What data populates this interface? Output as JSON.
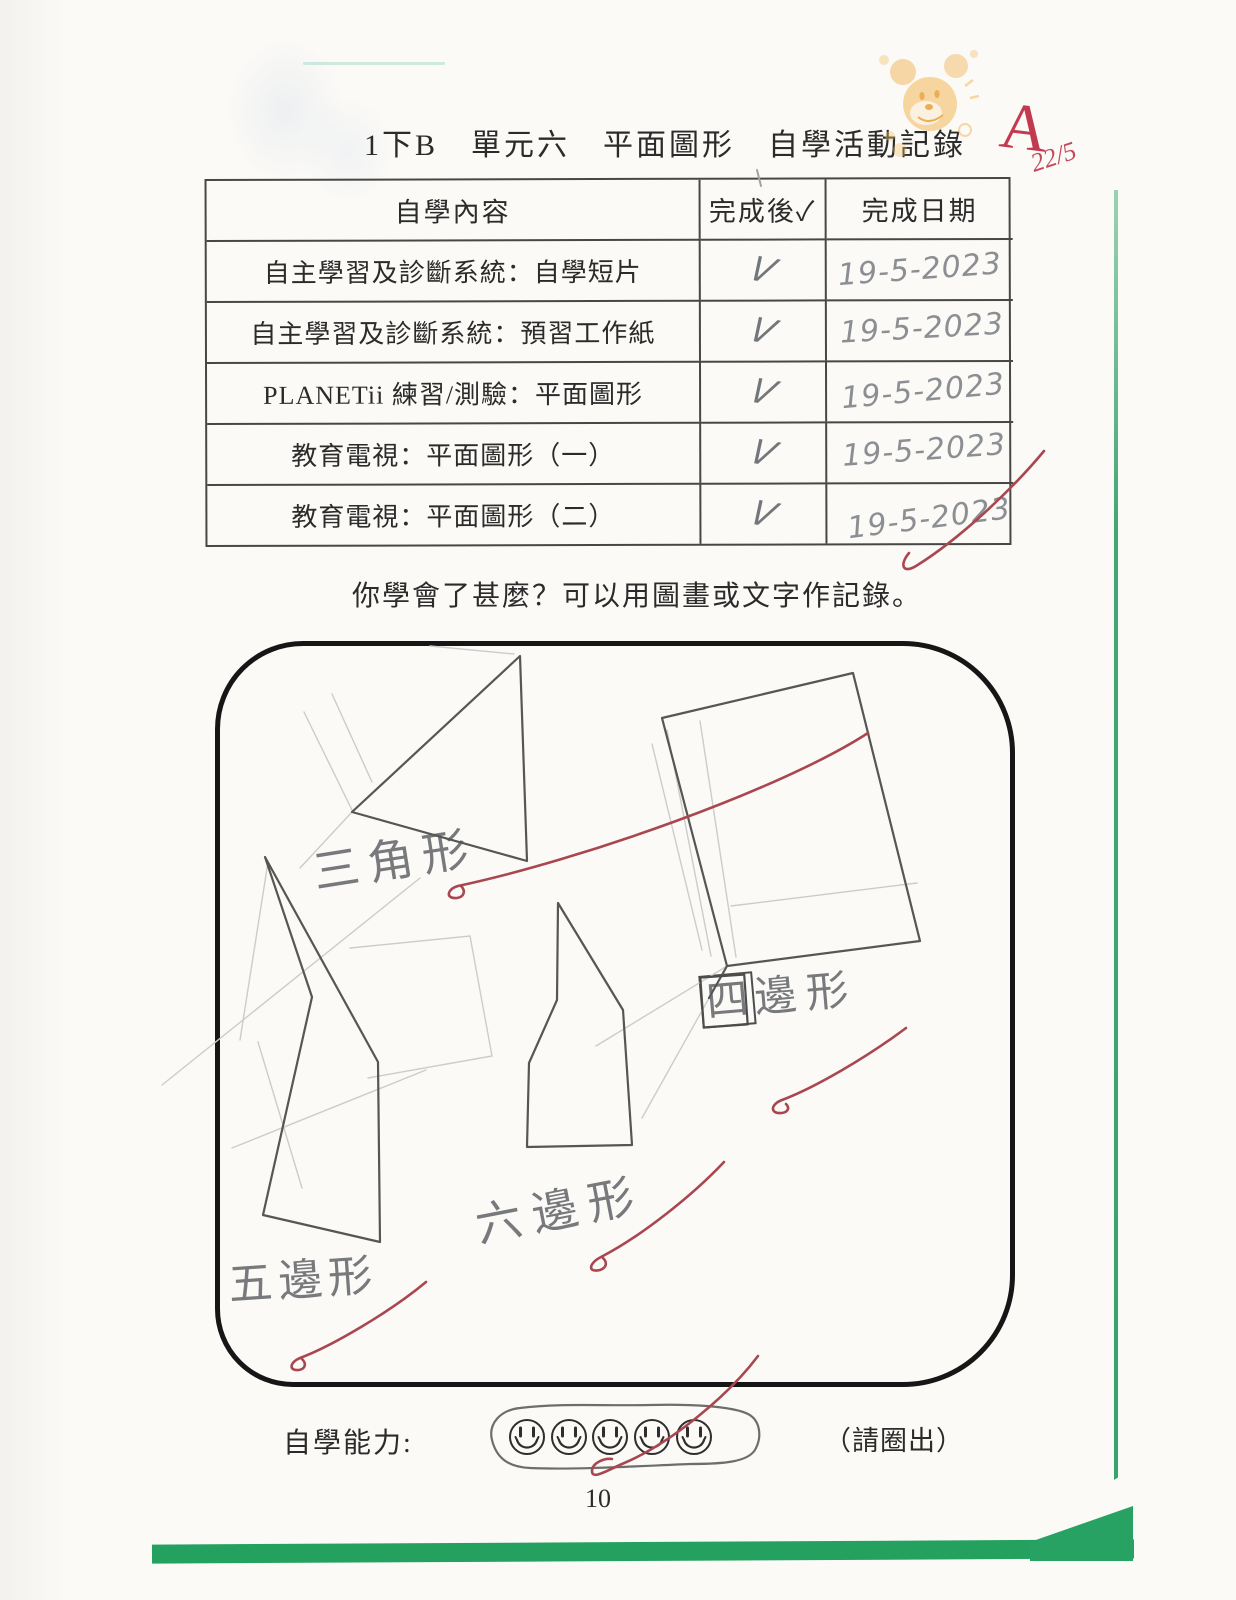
{
  "page": {
    "title": "1下B　單元六　平面圖形　自學活動記錄",
    "prompt": "你學會了甚麼？可以用圖畫或文字作記錄。",
    "page_number": "10",
    "background_color": "#fbfaf7",
    "book_edge_green": "#24a05f"
  },
  "teacher_marks": {
    "grade": "A",
    "date": "22/5",
    "ink_red": "#a84750",
    "stamp_icon": "mickey-stamp",
    "stamp_orange": "#f2a840"
  },
  "table": {
    "headers": [
      "自學內容",
      "完成後✓",
      "完成日期"
    ],
    "rows": [
      {
        "content": "自主學習及診斷系統：自學短片",
        "check": "V",
        "date": "19-5-2023"
      },
      {
        "content": "自主學習及診斷系統：預習工作紙",
        "check": "V",
        "date": "19-5-2023"
      },
      {
        "content": "PLANETii 練習/測驗：平面圖形",
        "check": "V",
        "date": "19-5-2023"
      },
      {
        "content": "教育電視：平面圖形（一）",
        "check": "V",
        "date": "19-5-2023"
      },
      {
        "content": "教育電視：平面圖形（二）",
        "check": "V",
        "date": "19-5-2023"
      }
    ]
  },
  "drawing": {
    "shapes": [
      "triangle",
      "quadrilateral",
      "pentagon",
      "hexagon"
    ],
    "labels": {
      "triangle": "三角形",
      "quad_boxed_char": "四",
      "quad_rest": "邊形",
      "pentagon": "五邊形",
      "hexagon": "六邊形"
    },
    "pencil_gray": "#77797c"
  },
  "footer": {
    "ability_label": "自學能力:",
    "circle_hint": "（請圈出）",
    "smiley_count": 5,
    "smiley_icon": "smiley-face-icon"
  }
}
